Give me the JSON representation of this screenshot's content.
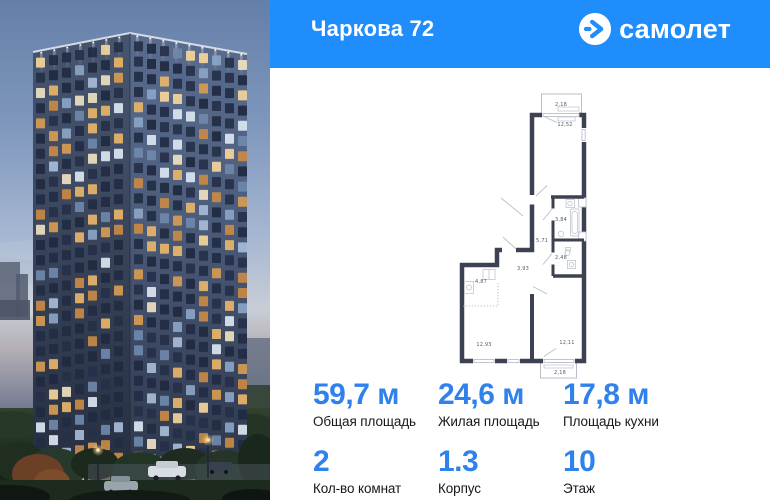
{
  "header": {
    "title": "Чаркова 72",
    "brand": "самолет"
  },
  "icons": {
    "brand_mark": "arrow-right-in-circle"
  },
  "colors": {
    "header_blue": "#1f8dfb",
    "accent_blue": "#2f82ec",
    "plan_wall": "#3c4251",
    "window_warm": "#d79b52"
  },
  "stats": {
    "items": [
      {
        "value": "59,7 м",
        "label": "Общая площадь"
      },
      {
        "value": "24,6 м",
        "label": "Жилая площадь"
      },
      {
        "value": "17,8 м",
        "label": "Площадь кухни"
      },
      {
        "value": "2",
        "label": "Кол-во комнат"
      },
      {
        "value": "1.3",
        "label": "Корпус"
      },
      {
        "value": "10",
        "label": "Этаж"
      }
    ]
  },
  "floorplan": {
    "room_areas": [
      {
        "value": "2,18",
        "x": 121,
        "y": 26
      },
      {
        "value": "12,52",
        "x": 125,
        "y": 46
      },
      {
        "value": "3,84",
        "x": 121,
        "y": 141
      },
      {
        "value": "5,71",
        "x": 102,
        "y": 162
      },
      {
        "value": "2,48",
        "x": 121,
        "y": 179
      },
      {
        "value": "3,93",
        "x": 83,
        "y": 190
      },
      {
        "value": "4,87",
        "x": 41,
        "y": 203
      },
      {
        "value": "12,93",
        "x": 44,
        "y": 266
      },
      {
        "value": "12,11",
        "x": 127,
        "y": 264
      },
      {
        "value": "2,18",
        "x": 120,
        "y": 294
      }
    ]
  }
}
